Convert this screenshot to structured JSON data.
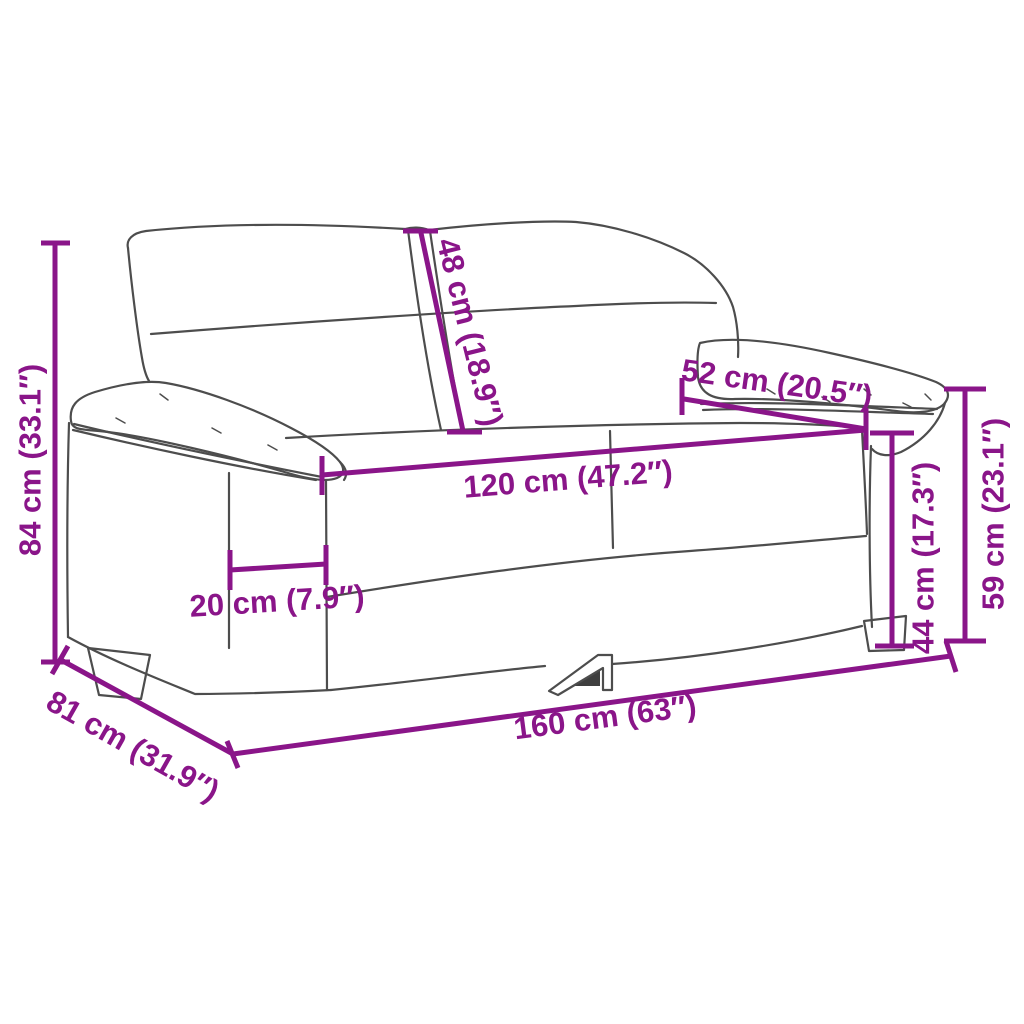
{
  "diagram": {
    "type": "furniture-dimension-diagram",
    "subject": "2-seater sofa line drawing with measurement annotations",
    "background_color": "#ffffff",
    "colors": {
      "dimension_accent": "#8A1589",
      "sofa_outline": "#4d4d4d",
      "leg_shadow": "#3f3f3f"
    },
    "measurements": [
      {
        "id": "overall-height",
        "label": "84 cm (33.1″)"
      },
      {
        "id": "backrest-height",
        "label": "48 cm (18.9″)"
      },
      {
        "id": "armrest-depth",
        "label": "52 cm (20.5″)"
      },
      {
        "id": "seat-width",
        "label": "120 cm (47.2″)"
      },
      {
        "id": "armrest-width",
        "label": "20 cm (7.9″)"
      },
      {
        "id": "seat-height",
        "label": "44 cm (17.3″)"
      },
      {
        "id": "armrest-height",
        "label": "59 cm (23.1″)"
      },
      {
        "id": "overall-width",
        "label": "160 cm (63″)"
      },
      {
        "id": "overall-depth",
        "label": "81 cm (31.9″)"
      }
    ]
  }
}
